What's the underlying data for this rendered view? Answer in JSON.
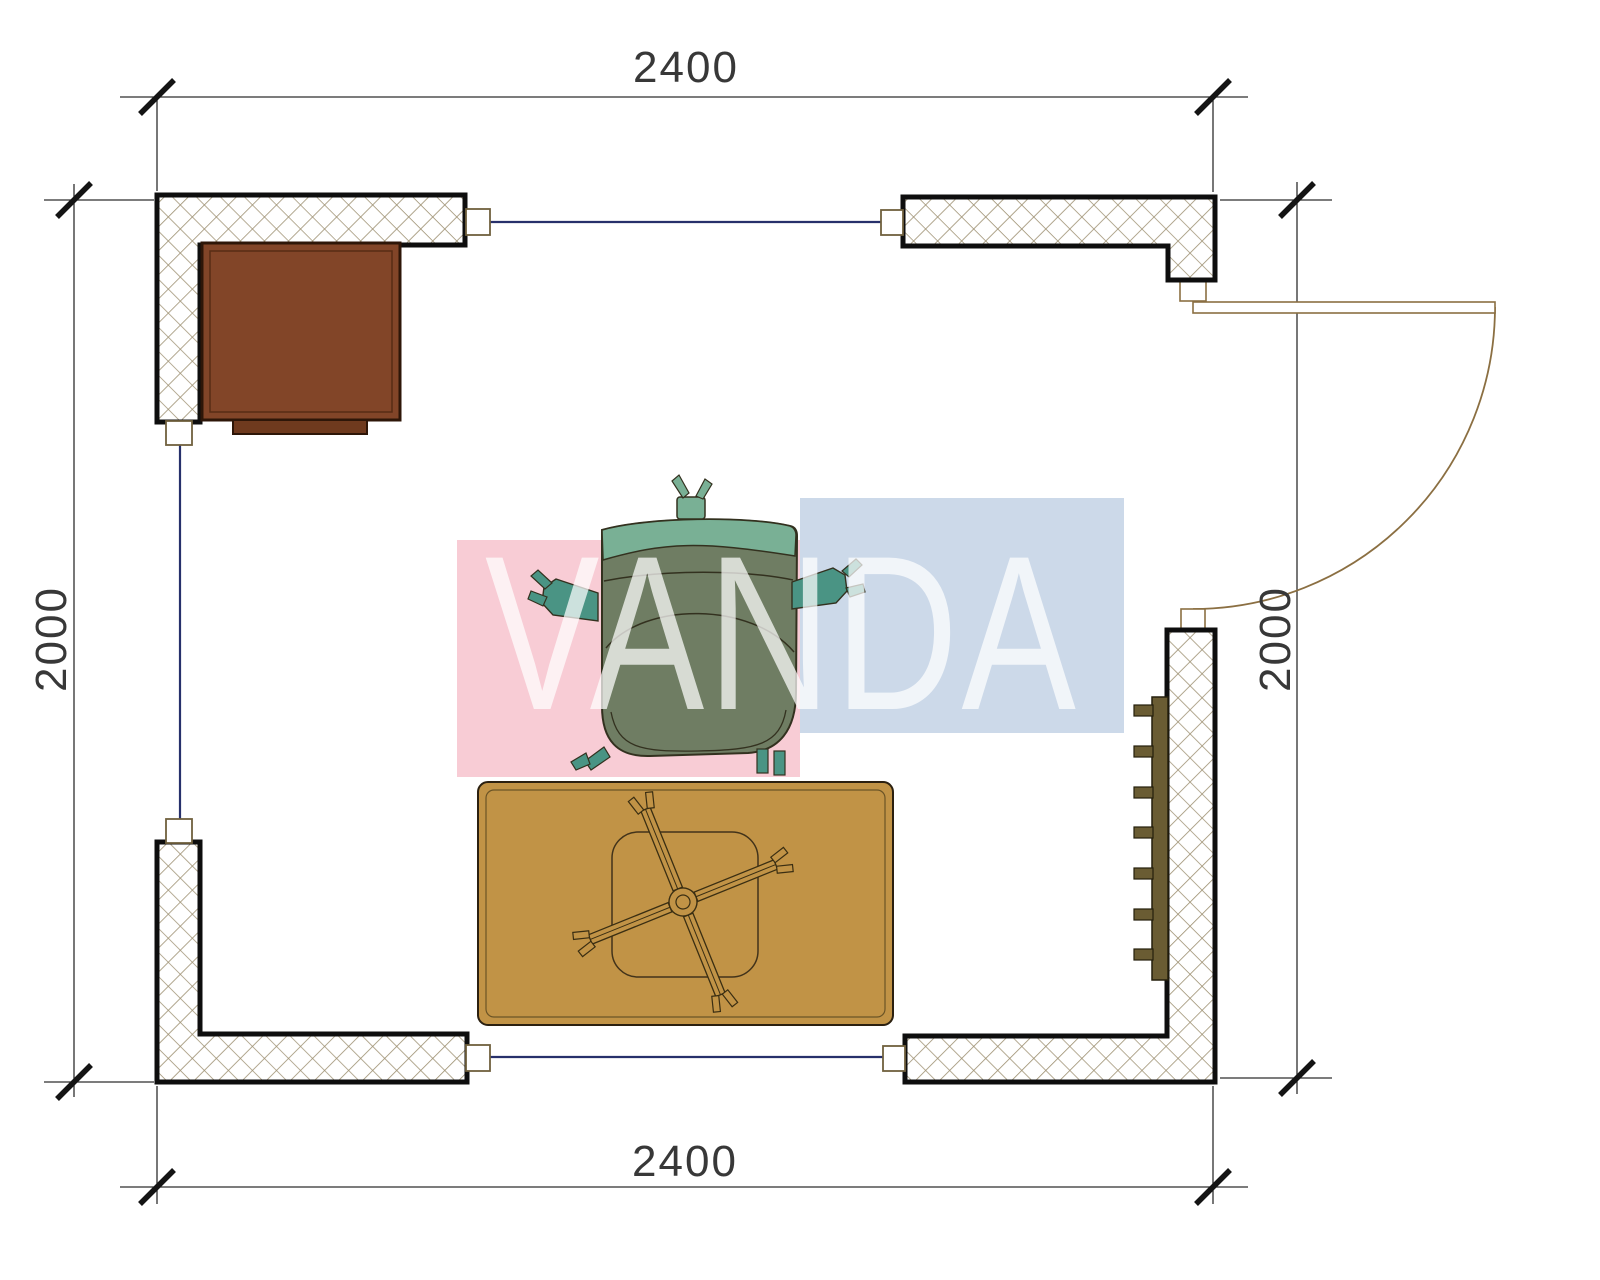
{
  "dimensions": {
    "top": "2400",
    "bottom": "2400",
    "left": "2000",
    "right": "2000"
  },
  "watermark": {
    "text": "VANDA",
    "pink_color": "#f8ccd5",
    "blue_color": "#ccd9e9",
    "letter_color": "rgba(255,255,255,0.72)"
  },
  "colors": {
    "wall_outline": "#0e0e0e",
    "hatch_line": "#9d9071",
    "window_line": "#27306b",
    "door_line": "#8b6f42",
    "dimension_line": "#2e2e2e",
    "cabinet_fill": "#824528",
    "rug_fill": "#c19346",
    "radiator_fill": "#6a5c33",
    "chair_seat": "#6f7d63",
    "chair_back": "#79b095",
    "chair_armrest": "#4a9484"
  }
}
